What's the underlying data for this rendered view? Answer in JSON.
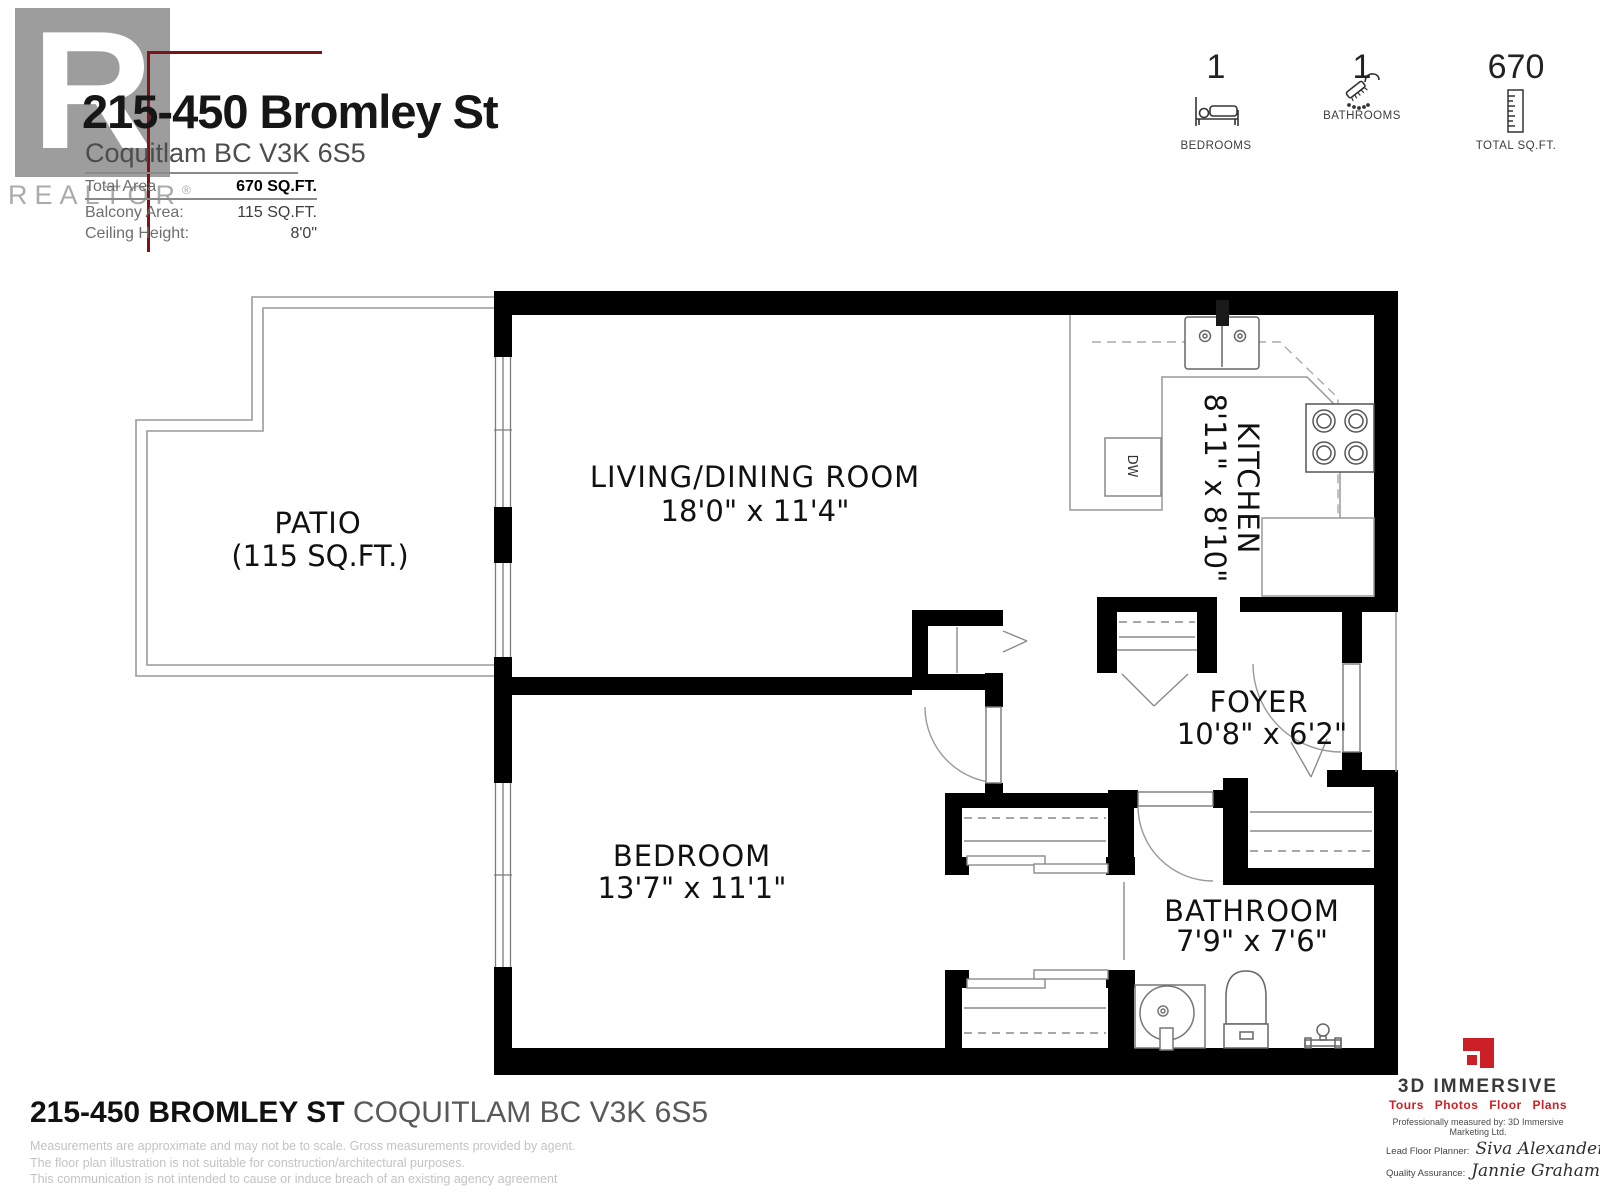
{
  "header": {
    "logo_letter": "R",
    "wordmark": "REALTOR",
    "registered_mark": "®",
    "address_line1": "215-450 Bromley St",
    "address_line2": "Coquitlam BC V3K 6S5",
    "stats": [
      {
        "label": "Total Area",
        "value": "670 SQ.FT."
      },
      {
        "label": "Balcony Area:",
        "value": "115 SQ.FT."
      },
      {
        "label": "Ceiling Height:",
        "value": "8'0\""
      }
    ],
    "summary": [
      {
        "count": "1",
        "label": "BEDROOMS"
      },
      {
        "count": "1",
        "label": "BATHROOMS"
      },
      {
        "count": "670",
        "label": "TOTAL SQ.FT."
      }
    ]
  },
  "floorplan": {
    "rooms": [
      {
        "name": "PATIO",
        "dims": "(115 SQ.FT.)"
      },
      {
        "name": "LIVING/DINING ROOM",
        "dims": "18'0\" x 11'4\""
      },
      {
        "name": "KITCHEN",
        "dims": "8'11\" x 8'10\""
      },
      {
        "name": "FOYER",
        "dims": "10'8\" x 6'2\""
      },
      {
        "name": "BEDROOM",
        "dims": "13'7\" x 11'1\""
      },
      {
        "name": "BATHROOM",
        "dims": "7'9\" x 7'6\""
      }
    ],
    "labels": {
      "dishwasher": "DW"
    }
  },
  "footer": {
    "address_bold": "215-450 BROMLEY ST",
    "address_rest": "COQUITLAM BC V3K 6S5",
    "fine_print": [
      "Measurements are approximate and may not be to scale. Gross measurements provided by agent.",
      "The floor plan illustration is not suitable for construction/architectural purposes.",
      "This communication is not intended to cause or induce breach of an existing agency agreement"
    ],
    "brand": {
      "name": "3D IMMERSIVE",
      "tagline": "Tours Photos Floor Plans",
      "measured_by": "Professionally measured by: 3D Immersive Marketing Ltd.",
      "planner_label": "Lead Floor Planner:",
      "planner_name": "Siva Alexander",
      "qa_label": "Quality Assurance:",
      "qa_name": "Jannie Graham"
    }
  },
  "colors": {
    "wall": "#000000",
    "accent_red": "#7d1417",
    "brand_red": "#cb2026",
    "logo_gray": "#9d9d9d"
  }
}
